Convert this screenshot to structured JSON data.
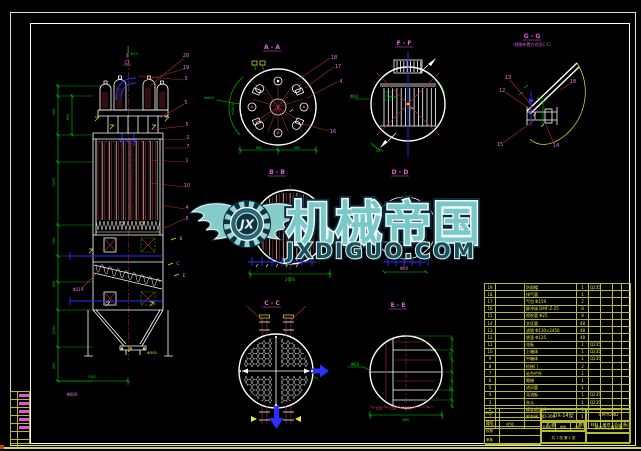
{
  "page": {
    "background": "#000000",
    "frame_outer_color": "#e3e3b0",
    "frame_inner_color": "#ffffff",
    "dim_color": "#00d000",
    "callout_color": "#e060e0",
    "leader_color": "#a83030",
    "table_color": "#e9e95a",
    "watermark_teal": "#7cd0d0"
  },
  "watermark": {
    "logo_initials": "JX",
    "title": "机械帝国",
    "site": "JXDIGUO.COM"
  },
  "views": {
    "aa": {
      "label": "A - A"
    },
    "bb": {
      "label": "B - B"
    },
    "cc": {
      "label": "C - C"
    },
    "dd": {
      "label": "D - D"
    },
    "ee": {
      "label": "E - E"
    },
    "ff": {
      "label": "F - F"
    },
    "gg": {
      "label": "G - G",
      "note": "（视图布置方向见C-C）"
    }
  },
  "annotations": [
    {
      "t": "20",
      "x": 186,
      "y": 57,
      "c": "m",
      "s": 5
    },
    {
      "t": "19",
      "x": 186,
      "y": 69,
      "c": "m",
      "s": 5
    },
    {
      "t": "3",
      "x": 186,
      "y": 80,
      "c": "m",
      "s": 5
    },
    {
      "t": "5",
      "x": 186,
      "y": 104,
      "c": "m",
      "s": 5
    },
    {
      "t": "5",
      "x": 187,
      "y": 126,
      "c": "m",
      "s": 5
    },
    {
      "t": "2",
      "x": 188,
      "y": 139,
      "c": "m",
      "s": 5
    },
    {
      "t": "7",
      "x": 188,
      "y": 148,
      "c": "m",
      "s": 5
    },
    {
      "t": "1",
      "x": 187,
      "y": 162,
      "c": "m",
      "s": 5
    },
    {
      "t": "10",
      "x": 187,
      "y": 187,
      "c": "m",
      "s": 5
    },
    {
      "t": "4",
      "x": 187,
      "y": 209,
      "c": "m",
      "s": 5
    },
    {
      "t": "8",
      "x": 187,
      "y": 220,
      "c": "m",
      "s": 5
    },
    {
      "t": "B",
      "x": 181,
      "y": 240,
      "c": "m",
      "s": 4.5
    },
    {
      "t": "C",
      "x": 178,
      "y": 265,
      "c": "m",
      "s": 4.5
    },
    {
      "t": "E",
      "x": 184,
      "y": 277,
      "c": "m",
      "s": 4.5
    },
    {
      "t": "18",
      "x": 334,
      "y": 59,
      "c": "m",
      "s": 5
    },
    {
      "t": "17",
      "x": 338,
      "y": 68,
      "c": "m",
      "s": 5
    },
    {
      "t": "4",
      "x": 341,
      "y": 83,
      "c": "m",
      "s": 5
    },
    {
      "t": "16",
      "x": 333,
      "y": 133,
      "c": "m",
      "s": 5
    },
    {
      "t": "13",
      "x": 508,
      "y": 79,
      "c": "m",
      "s": 5
    },
    {
      "t": "12",
      "x": 502,
      "y": 92,
      "c": "m",
      "s": 5
    },
    {
      "t": "18",
      "x": 573,
      "y": 83,
      "c": "m",
      "s": 5
    },
    {
      "t": "15",
      "x": 500,
      "y": 146,
      "c": "m",
      "s": 5
    },
    {
      "t": "14",
      "x": 556,
      "y": 147,
      "c": "m",
      "s": 5
    },
    {
      "t": "Φ60",
      "x": 404,
      "y": 270,
      "c": "m",
      "s": 4
    },
    {
      "t": "Φ219",
      "x": 78,
      "y": 291,
      "c": "m",
      "s": 4
    },
    {
      "t": "Φ600",
      "x": 72,
      "y": 396,
      "c": "m",
      "s": 4
    },
    {
      "t": "Φ25",
      "x": 134,
      "y": 55,
      "c": "g",
      "s": 3.5
    },
    {
      "t": "450",
      "x": 55,
      "y": 112,
      "c": "g",
      "s": 3.5,
      "r": -90
    },
    {
      "t": "2450",
      "x": 55,
      "y": 182,
      "c": "g",
      "s": 3.5,
      "r": -90
    },
    {
      "t": "700",
      "x": 55,
      "y": 241,
      "c": "g",
      "s": 3.5,
      "r": -90
    },
    {
      "t": "950",
      "x": 55,
      "y": 284,
      "c": "g",
      "s": 3.5,
      "r": -90
    },
    {
      "t": "1100",
      "x": 55,
      "y": 330,
      "c": "g",
      "s": 3.5,
      "r": -90
    },
    {
      "t": "300",
      "x": 55,
      "y": 366,
      "c": "g",
      "s": 3.5,
      "r": -90
    },
    {
      "t": "900",
      "x": 69,
      "y": 117,
      "c": "g",
      "s": 3.5,
      "r": -90
    },
    {
      "t": "1400",
      "x": 92,
      "y": 378,
      "c": "g",
      "s": 3.5
    },
    {
      "t": "Φ2600",
      "x": 234,
      "y": 109,
      "c": "g",
      "s": 3.5,
      "r": -90
    },
    {
      "t": "660",
      "x": 259,
      "y": 149,
      "c": "g",
      "s": 3.5
    },
    {
      "t": "660",
      "x": 297,
      "y": 149,
      "c": "g",
      "s": 3.5
    },
    {
      "t": "Φ600",
      "x": 209,
      "y": 99,
      "c": "g",
      "s": 3.5
    },
    {
      "t": "Φ60",
      "x": 354,
      "y": 98,
      "c": "g",
      "s": 4
    },
    {
      "t": "Φ159",
      "x": 392,
      "y": 98,
      "c": "g",
      "s": 3
    },
    {
      "t": "45°",
      "x": 379,
      "y": 152,
      "c": "g",
      "s": 3.5
    },
    {
      "t": "2600",
      "x": 290,
      "y": 281,
      "c": "g",
      "s": 4
    },
    {
      "t": "Φ60",
      "x": 540,
      "y": 99,
      "c": "g",
      "s": 3
    },
    {
      "t": "Φ60",
      "x": 355,
      "y": 366,
      "c": "g",
      "s": 4
    },
    {
      "t": "660",
      "x": 406,
      "y": 421,
      "c": "g",
      "s": 3.5
    },
    {
      "t": "150",
      "x": 451,
      "y": 355,
      "c": "g",
      "s": 3,
      "r": -90
    },
    {
      "t": "150",
      "x": 451,
      "y": 389,
      "c": "g",
      "s": 3,
      "r": -90
    },
    {
      "t": "Φ300",
      "x": 152,
      "y": 354,
      "c": "y",
      "s": 3.5
    },
    {
      "t": "120",
      "x": 379,
      "y": 410,
      "c": "r",
      "s": 3.5
    },
    {
      "t": "120",
      "x": 393,
      "y": 410,
      "c": "r",
      "s": 3.5
    },
    {
      "t": "120",
      "x": 407,
      "y": 410,
      "c": "r",
      "s": 3.5
    }
  ],
  "bom": {
    "headers": [
      "序号",
      "代号",
      "名 称",
      "数量",
      "材料",
      "单件",
      "总计",
      "备注"
    ],
    "rows": [
      {
        "no": "19",
        "code": "",
        "name": "防雨帽",
        "qty": "1",
        "mat": "Q235",
        "unit": "",
        "total": "",
        "note": ""
      },
      {
        "no": "18",
        "code": "",
        "name": "排气管",
        "qty": "1",
        "mat": "",
        "unit": "",
        "total": "",
        "note": ""
      },
      {
        "no": "17",
        "code": "",
        "name": "气包 Φ159",
        "qty": "2",
        "mat": "",
        "unit": "",
        "total": "",
        "note": ""
      },
      {
        "no": "16",
        "code": "",
        "name": "脉冲阀 DMF-Z-25",
        "qty": "8",
        "mat": "",
        "unit": "",
        "total": "",
        "note": ""
      },
      {
        "no": "15",
        "code": "",
        "name": "喷吹管 Φ25",
        "qty": "8",
        "mat": "",
        "unit": "",
        "total": "",
        "note": ""
      },
      {
        "no": "14",
        "code": "",
        "name": "文氏管",
        "qty": "48",
        "mat": "",
        "unit": "",
        "total": "",
        "note": ""
      },
      {
        "no": "13",
        "code": "",
        "name": "滤袋 Φ130×2450",
        "qty": "48",
        "mat": "",
        "unit": "",
        "total": "",
        "note": ""
      },
      {
        "no": "12",
        "code": "",
        "name": "袋笼 Φ125",
        "qty": "48",
        "mat": "",
        "unit": "",
        "total": "",
        "note": ""
      },
      {
        "no": "11",
        "code": "",
        "name": "花板",
        "qty": "1",
        "mat": "Q235",
        "unit": "",
        "total": "",
        "note": ""
      },
      {
        "no": "10",
        "code": "",
        "name": "上箱体",
        "qty": "1",
        "mat": "Q235",
        "unit": "",
        "total": "",
        "note": ""
      },
      {
        "no": "9",
        "code": "",
        "name": "中箱体",
        "qty": "1",
        "mat": "Q235",
        "unit": "",
        "total": "",
        "note": ""
      },
      {
        "no": "8",
        "code": "",
        "name": "检修门",
        "qty": "2",
        "mat": "",
        "unit": "",
        "total": "",
        "note": ""
      },
      {
        "no": "7",
        "code": "",
        "name": "走台栏杆",
        "qty": "1",
        "mat": "",
        "unit": "",
        "total": "",
        "note": ""
      },
      {
        "no": "6",
        "code": "",
        "name": "爬梯",
        "qty": "1",
        "mat": "",
        "unit": "",
        "total": "",
        "note": ""
      },
      {
        "no": "5",
        "code": "",
        "name": "进风管",
        "qty": "1",
        "mat": "",
        "unit": "",
        "total": "",
        "note": ""
      },
      {
        "no": "4",
        "code": "",
        "name": "导流板",
        "qty": "1",
        "mat": "Q235",
        "unit": "",
        "total": "",
        "note": ""
      },
      {
        "no": "3",
        "code": "",
        "name": "灰斗",
        "qty": "1",
        "mat": "Q235",
        "unit": "",
        "total": "",
        "note": ""
      },
      {
        "no": "2",
        "code": "",
        "name": "螺旋输送机",
        "qty": "1",
        "mat": "",
        "unit": "",
        "total": "",
        "note": ""
      },
      {
        "no": "1",
        "code": "",
        "name": "卸灰阀 YJD-300",
        "qty": "1",
        "mat": "",
        "unit": "",
        "total": "",
        "note": ""
      }
    ]
  },
  "title_block": {
    "model": "DX-14型",
    "company": "CMYOND",
    "product": "袋式除尘器总图",
    "stage": "阶段标记",
    "weight": "重量",
    "scale": "比例",
    "sheet": "共 1 张  第 1 张",
    "left_rows": [
      "标记",
      "设计",
      "校核",
      "审核"
    ]
  }
}
